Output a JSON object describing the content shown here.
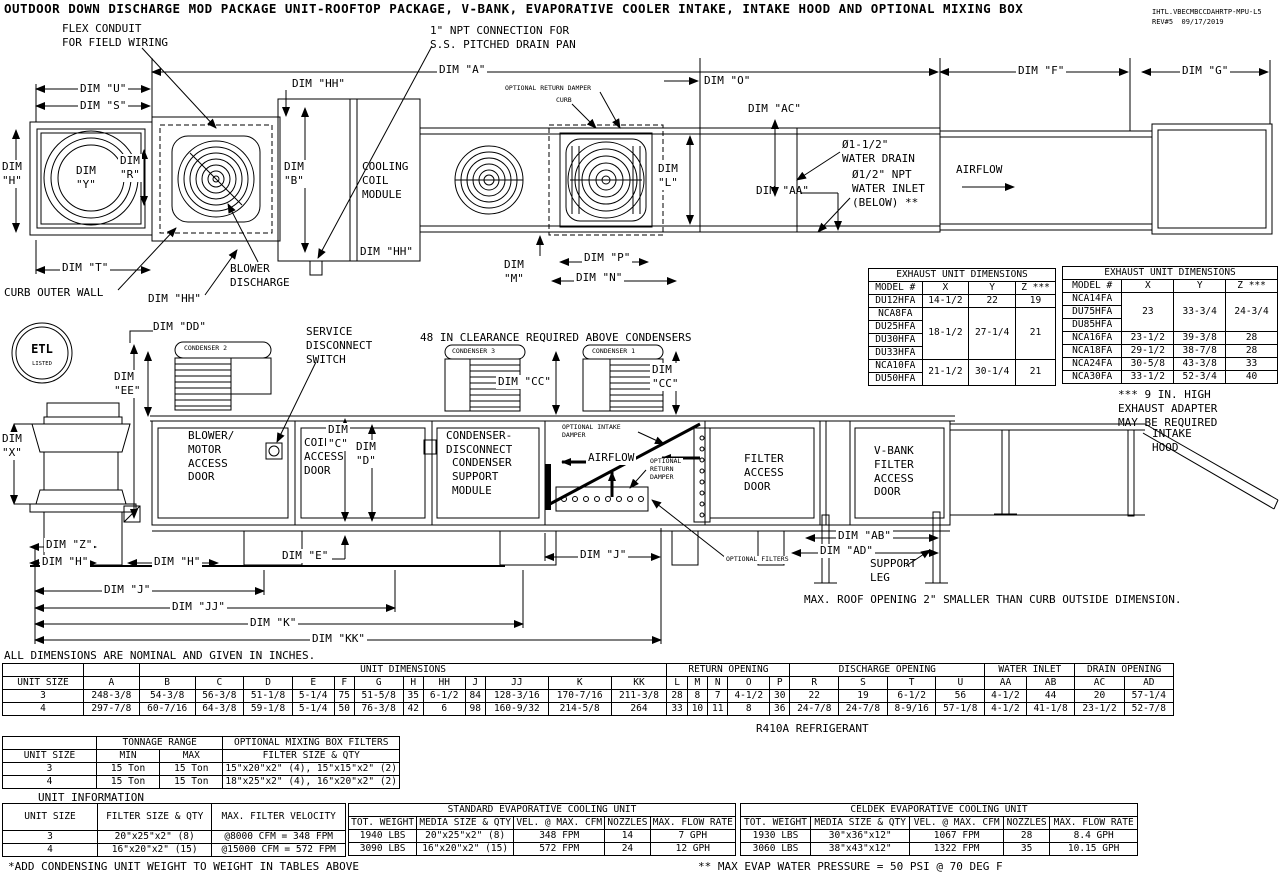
{
  "title": "OUTDOOR DOWN DISCHARGE MOD PACKAGE UNIT-ROOFTOP PACKAGE, V-BANK, EVAPORATIVE COOLER INTAKE, INTAKE HOOD AND OPTIONAL MIXING BOX",
  "docref": {
    "id": "IHTL.VBECMBCCDAHRTP-MPU-L5",
    "rev": "REV#5  09/17/2019"
  },
  "plan": {
    "flex_conduit": "FLEX CONDUIT\nFOR FIELD WIRING",
    "npt_connection": "1\" NPT CONNECTION FOR\nS.S. PITCHED DRAIN PAN",
    "dim_a": "DIM \"A\"",
    "dim_u": "DIM \"U\"",
    "dim_s": "DIM \"S\"",
    "dim_hh_top": "DIM \"HH\"",
    "optional_return_damper": "OPTIONAL RETURN DAMPER",
    "curb": "CURB",
    "dim_o": "DIM \"O\"",
    "dim_ac": "DIM \"AC\"",
    "dim_f": "DIM \"F\"",
    "dim_g": "DIM \"G\"",
    "dim_h": "DIM\n\"H\"",
    "dim_y": "DIM\n\"Y\"",
    "dim_r": "DIM\n\"R\"",
    "dim_b": "DIM\n\"B\"",
    "cooling_coil_module": "COOLING\nCOIL\nMODULE",
    "dim_hh_right": "DIM \"HH\"",
    "dim_l": "DIM\n\"L\"",
    "water_drain": "Ø1-1/2\"\nWATER DRAIN",
    "water_inlet": "Ø1/2\" NPT\nWATER INLET\n(BELOW) **",
    "dim_aa": "DIM \"AA\"",
    "airflow": "AIRFLOW",
    "dim_t": "DIM \"T\"",
    "curb_outer_wall": "CURB OUTER WALL",
    "dim_hh_bottom": "DIM \"HH\"",
    "blower_discharge": "BLOWER\nDISCHARGE",
    "dim_m": "DIM\n\"M\"",
    "dim_p": "DIM \"P\"",
    "dim_n": "DIM \"N\""
  },
  "elev": {
    "dim_dd": "DIM \"DD\"",
    "condenser_2": "CONDENSER 2",
    "condenser_3": "CONDENSER 3",
    "condenser_1": "CONDENSER 1",
    "service_disconnect": "SERVICE\nDISCONNECT\nSWITCH",
    "clearance_note": "48 IN CLEARANCE REQUIRED ABOVE CONDENSERS",
    "dim_cc_right": "DIM \"CC\"",
    "dim_cc_far": "DIM\n\"CC\"",
    "dim_ee": "DIM\n\"EE\"",
    "dim_x": "DIM\n\"X\"",
    "blower_motor_door": "BLOWER/\nMOTOR\nACCESS\nDOOR",
    "coil_access_door": "COIL\nACCESS\nDOOR",
    "dim_c": "DIM\n\"C\"",
    "dim_d": "DIM\n\"D\"",
    "condenser_disconnect": "CONDENSER-\nDISCONNECT",
    "condenser_support_module": "CONDENSER\nSUPPORT\nMODULE",
    "optional_intake_damper": "OPTIONAL INTAKE\nDAMPER",
    "airflow": "AIRFLOW",
    "optional_return_damper": "OPTIONAL\nRETURN\nDAMPER",
    "filter_access_door": "FILTER\nACCESS\nDOOR",
    "vbank_door": "V-BANK\nFILTER\nACCESS\nDOOR",
    "intake_hood": "INTAKE\nHOOD",
    "dim_ab": "DIM \"AB\"",
    "dim_ad": "DIM \"AD\"",
    "support_leg": "SUPPORT\nLEG",
    "optional_filters": "OPTIONAL FILTERS",
    "roof_note": "MAX. ROOF OPENING 2\" SMALLER THAN CURB OUTSIDE DIMENSION.",
    "dim_z": "DIM \"Z\"",
    "dim_h_left": "DIM \"H\"",
    "dim_h_mid": "DIM \"H\"",
    "dim_e": "DIM \"E\"",
    "dim_j_upper": "DIM \"J\"",
    "dim_j": "DIM \"J\"",
    "dim_jj": "DIM \"JJ\"",
    "dim_k": "DIM \"K\"",
    "dim_kk": "DIM \"KK\"",
    "etl_letters": "ETL",
    "etl_listed": "LISTED"
  },
  "exhaust_note": "*** 9 IN. HIGH\nEXHAUST ADAPTER\nMAY BE REQUIRED",
  "dims_note": "ALL DIMENSIONS ARE NOMINAL AND GIVEN IN INCHES.",
  "refrigerant_note": "R410A REFRIGERANT",
  "unit_information_label": "UNIT INFORMATION",
  "footnote_weight": "*ADD CONDENSING UNIT WEIGHT TO WEIGHT IN TABLES ABOVE",
  "footnote_pressure": "** MAX EVAP WATER PRESSURE = 50 PSI @ 70 DEG F",
  "exhaust_left": {
    "title": "EXHAUST UNIT DIMENSIONS",
    "headers": [
      "MODEL #",
      "X",
      "Y",
      "Z ***"
    ],
    "g1": {
      "model": "DU12HFA",
      "x": "14-1/2",
      "y": "22",
      "z": "19"
    },
    "g2": {
      "models": [
        "NCA8FA",
        "DU25HFA",
        "DU30HFA",
        "DU33HFA"
      ],
      "x": "18-1/2",
      "y": "27-1/4",
      "z": "21"
    },
    "g3": {
      "models": [
        "NCA10FA",
        "DU50HFA"
      ],
      "x": "21-1/2",
      "y": "30-1/4",
      "z": "21"
    }
  },
  "exhaust_right": {
    "title": "EXHAUST UNIT DIMENSIONS",
    "headers": [
      "MODEL #",
      "X",
      "Y",
      "Z ***"
    ],
    "g1": {
      "models": [
        "NCA14FA",
        "DU75HFA",
        "DU85HFA"
      ],
      "x": "23",
      "y": "33-3/4",
      "z": "24-3/4"
    },
    "rows": [
      {
        "model": "NCA16FA",
        "x": "23-1/2",
        "y": "39-3/8",
        "z": "28"
      },
      {
        "model": "NCA18FA",
        "x": "29-1/2",
        "y": "38-7/8",
        "z": "28"
      },
      {
        "model": "NCA24FA",
        "x": "30-5/8",
        "y": "43-3/8",
        "z": "33"
      },
      {
        "model": "NCA30FA",
        "x": "33-1/2",
        "y": "52-3/4",
        "z": "40"
      }
    ]
  },
  "main_table": {
    "unit_size": "UNIT SIZE",
    "groups": {
      "unit_dimensions": "UNIT DIMENSIONS",
      "return_opening": "RETURN OPENING",
      "discharge_opening": "DISCHARGE OPENING",
      "water_inlet": "WATER INLET",
      "drain_opening": "DRAIN OPENING"
    },
    "columns": [
      "A",
      "B",
      "C",
      "D",
      "E",
      "F",
      "G",
      "H",
      "HH",
      "J",
      "JJ",
      "K",
      "KK",
      "L",
      "M",
      "N",
      "O",
      "P",
      "R",
      "S",
      "T",
      "U",
      "AA",
      "AB",
      "AC",
      "AD"
    ],
    "rows": [
      {
        "size": "3",
        "v": [
          "248-3/8",
          "54-3/8",
          "56-3/8",
          "51-1/8",
          "5-1/4",
          "75",
          "51-5/8",
          "35",
          "6-1/2",
          "84",
          "128-3/16",
          "170-7/16",
          "211-3/8",
          "28",
          "8",
          "7",
          "4-1/2",
          "30",
          "22",
          "19",
          "6-1/2",
          "56",
          "4-1/2",
          "44",
          "20",
          "57-1/4"
        ]
      },
      {
        "size": "4",
        "v": [
          "297-7/8",
          "60-7/16",
          "64-3/8",
          "59-1/8",
          "5-1/4",
          "50",
          "76-3/8",
          "42",
          "6",
          "98",
          "160-9/32",
          "214-5/8",
          "264",
          "33",
          "10",
          "11",
          "8",
          "36",
          "24-7/8",
          "24-7/8",
          "8-9/16",
          "57-1/8",
          "4-1/2",
          "41-1/8",
          "23-1/2",
          "52-7/8"
        ]
      }
    ]
  },
  "tonnage_table": {
    "unit_size": "UNIT SIZE",
    "tonnage_range": "TONNAGE RANGE",
    "mixing_box": "OPTIONAL MIXING BOX FILTERS",
    "min": "MIN",
    "max": "MAX",
    "filter_size_qty": "FILTER SIZE & QTY",
    "rows": [
      {
        "size": "3",
        "min": "15 Ton",
        "max": "15 Ton",
        "filters": "15\"x20\"x2\" (4), 15\"x15\"x2\" (2)"
      },
      {
        "size": "4",
        "min": "15 Ton",
        "max": "15 Ton",
        "filters": "18\"x25\"x2\" (4), 16\"x20\"x2\" (2)"
      }
    ]
  },
  "unit_info_table": {
    "headers": [
      "UNIT SIZE",
      "FILTER SIZE & QTY",
      "MAX. FILTER VELOCITY"
    ],
    "rows": [
      [
        "3",
        "20\"x25\"x2\" (8)",
        "@8000 CFM = 348 FPM"
      ],
      [
        "4",
        "16\"x20\"x2\" (15)",
        "@15000 CFM = 572 FPM"
      ]
    ]
  },
  "standard_evap": {
    "title": "STANDARD EVAPORATIVE COOLING UNIT",
    "headers": [
      "TOT. WEIGHT",
      "MEDIA SIZE & QTY",
      "VEL. @ MAX. CFM",
      "NOZZLES",
      "MAX. FLOW RATE"
    ],
    "rows": [
      [
        "1940 LBS",
        "20\"x25\"x2\" (8)",
        "348 FPM",
        "14",
        "7 GPH"
      ],
      [
        "3090 LBS",
        "16\"x20\"x2\" (15)",
        "572 FPM",
        "24",
        "12 GPH"
      ]
    ]
  },
  "celdek_evap": {
    "title": "CELDEK EVAPORATIVE COOLING UNIT",
    "headers": [
      "TOT. WEIGHT",
      "MEDIA SIZE & QTY",
      "VEL. @ MAX. CFM",
      "NOZZLES",
      "MAX. FLOW RATE"
    ],
    "rows": [
      [
        "1930 LBS",
        "30\"x36\"x12\"",
        "1067 FPM",
        "28",
        "8.4 GPH"
      ],
      [
        "3060 LBS",
        "38\"x43\"x12\"",
        "1322 FPM",
        "35",
        "10.15 GPH"
      ]
    ]
  },
  "colors": {
    "line": "#000000",
    "background": "#ffffff"
  }
}
